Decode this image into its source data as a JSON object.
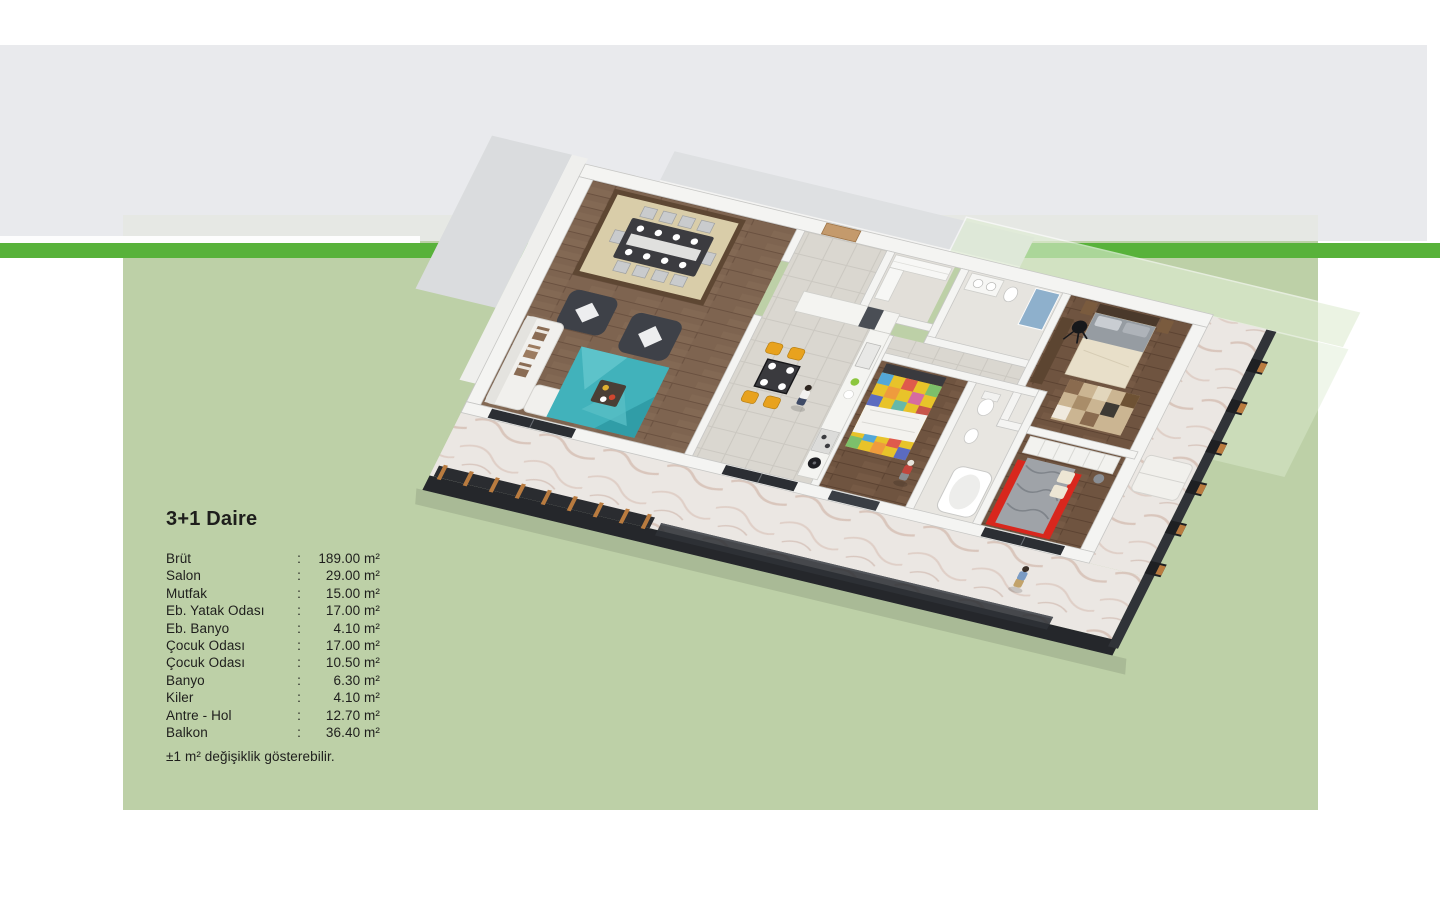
{
  "colors": {
    "accent_green": "#58B23A",
    "panel_green": "#BDD0A7",
    "band_gray": "#E9EAED"
  },
  "info_panel": {
    "title": "3+1 Daire",
    "rows": [
      {
        "label": "Brüt",
        "sep": ":",
        "value": "189.00 m²"
      },
      {
        "label": "Salon",
        "sep": ":",
        "value": "29.00 m²"
      },
      {
        "label": "Mutfak",
        "sep": ":",
        "value": "15.00 m²"
      },
      {
        "label": "Eb. Yatak Odası",
        "sep": ":",
        "value": "17.00 m²"
      },
      {
        "label": "Eb. Banyo",
        "sep": ":",
        "value": "4.10 m²"
      },
      {
        "label": "Çocuk Odası",
        "sep": ":",
        "value": "17.00 m²"
      },
      {
        "label": "Çocuk Odası",
        "sep": ":",
        "value": "10.50 m²"
      },
      {
        "label": "Banyo",
        "sep": ":",
        "value": "6.30 m²"
      },
      {
        "label": "Kiler",
        "sep": ":",
        "value": "4.10 m²"
      },
      {
        "label": "Antre - Hol",
        "sep": ":",
        "value": "12.70 m²"
      },
      {
        "label": "Balkon",
        "sep": ":",
        "value": "36.40 m²"
      }
    ],
    "footnote": "±1 m² değişiklik gösterebilir."
  }
}
